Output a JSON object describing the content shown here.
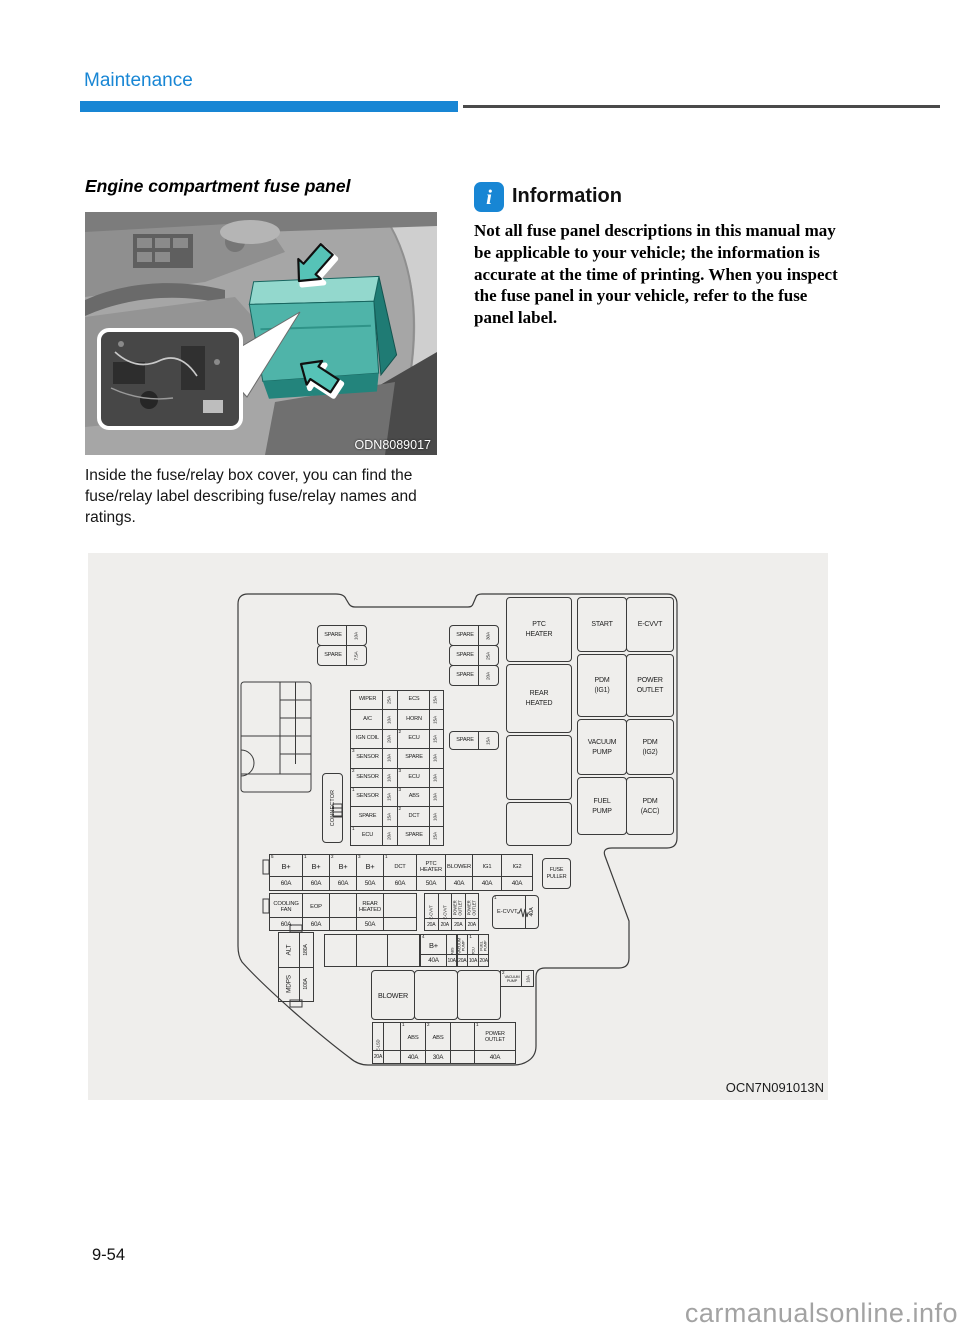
{
  "page": {
    "section": "Maintenance",
    "page_number": "9-54",
    "watermark": "carmanualsonline.info"
  },
  "left": {
    "heading": "Engine compartment fuse panel",
    "photo_code": "ODN8089017",
    "body": "Inside the fuse/relay box cover, you can find the fuse/relay label describing fuse/relay names and ratings."
  },
  "info": {
    "icon": "i",
    "title": "Information",
    "text": "Not all fuse panel descriptions in this manual may be applicable to your vehicle; the information is accurate at the time of printing. When you inspect the fuse panel in your vehicle, refer to the fuse panel label."
  },
  "figure": {
    "code": "OCN7N091013N"
  },
  "colors": {
    "accent_blue": "#1886d4",
    "panel_gray": "#efeeec",
    "fusebox_teal": "#4fb4a9"
  },
  "diagram": {
    "connector": "CONNECTOR",
    "spares_top_left": [
      [
        "SPARE",
        "10A"
      ],
      [
        "SPARE",
        "7.5A"
      ]
    ],
    "spares_top_right": [
      [
        "SPARE",
        "30A"
      ],
      [
        "SPARE",
        "25A"
      ],
      [
        "SPARE",
        "20A"
      ]
    ],
    "spare_mid": [
      "SPARE",
      "15A"
    ],
    "grid_rows": [
      [
        [
          "",
          "WIPER",
          "25A"
        ],
        [
          "",
          "ECS",
          "15A"
        ]
      ],
      [
        [
          "",
          "A/C",
          "10A"
        ],
        [
          "",
          "HORN",
          "15A"
        ]
      ],
      [
        [
          "",
          "IGN COIL",
          "20A"
        ],
        [
          "2",
          "ECU",
          "15A"
        ]
      ],
      [
        [
          "3",
          "SENSOR",
          "10A"
        ],
        [
          "",
          "SPARE",
          "10A"
        ]
      ],
      [
        [
          "2",
          "SENSOR",
          "10A"
        ],
        [
          "3",
          "ECU",
          "10A"
        ]
      ],
      [
        [
          "1",
          "SENSOR",
          "15A"
        ],
        [
          "3",
          "ABS",
          "10A"
        ]
      ],
      [
        [
          "",
          "SPARE",
          "15A"
        ],
        [
          "2",
          "DCT",
          "10A"
        ]
      ],
      [
        [
          "1",
          "ECU",
          "20A"
        ],
        [
          "",
          "SPARE",
          "15A"
        ]
      ]
    ],
    "relays": [
      [
        "PTC",
        "HEATER"
      ],
      [
        "REAR",
        "HEATED"
      ],
      [],
      [],
      [
        "START"
      ],
      [
        "E-CVVT"
      ],
      [
        "PDM",
        "(IG1)"
      ],
      [
        "POWER",
        "OUTLET"
      ],
      [
        "VACUUM",
        "PUMP"
      ],
      [
        "PDM",
        "(IG2)"
      ],
      [
        "FUEL",
        "PUMP"
      ],
      [
        "PDM",
        "(ACC)"
      ]
    ],
    "row_a": [
      [
        "5",
        "B+",
        "60A"
      ],
      [
        "1",
        "B+",
        "60A"
      ],
      [
        "2",
        "B+",
        "60A"
      ],
      [
        "3",
        "B+",
        "50A"
      ],
      [
        "1",
        "DCT",
        "60A"
      ],
      [
        "",
        "PTC HEATER",
        "50A"
      ],
      [
        "",
        "BLOWER",
        "40A"
      ],
      [
        "",
        "IG1",
        "40A"
      ],
      [
        "",
        "IG2",
        "40A"
      ]
    ],
    "fuse_puller": [
      "FUSE",
      "PULLER"
    ],
    "row_b": [
      [
        "",
        "COOLING FAN",
        "60A"
      ],
      [
        "",
        "EOP",
        "60A"
      ],
      [
        "",
        "",
        ""
      ],
      [
        "",
        "REAR HEATED",
        "50A"
      ],
      [
        "",
        "",
        ""
      ]
    ],
    "row_b_vertical": [
      [
        "",
        "E-CVVT",
        "20A"
      ],
      [
        "",
        "E-CVVT",
        "20A"
      ],
      [
        "",
        "POWER OUTLET",
        "20A"
      ],
      [
        "",
        "POWER OUTLET",
        "20A"
      ]
    ],
    "ecvvt_fuse": [
      "1",
      "E-CVVT",
      "40A"
    ],
    "alt_mdps": [
      [
        "ALT",
        "180A"
      ],
      [
        "MDPS",
        "100A"
      ]
    ],
    "row_c": [
      [
        "4",
        "B+",
        "40A"
      ],
      [
        "",
        "ABS",
        "10A"
      ],
      [
        "",
        "VACUUM PUMP",
        "20A"
      ],
      [
        "1",
        "TCU",
        "10A"
      ],
      [
        "",
        "FUEL PUMP",
        "20A"
      ]
    ],
    "vacuum_small": [
      "2",
      "VACUUM PUMP",
      "10A"
    ],
    "blower": "BLOWER",
    "bottom_row": [
      [
        "",
        "E-LSD",
        "20A"
      ],
      [
        "",
        "",
        ""
      ],
      [
        "1",
        "ABS",
        "40A"
      ],
      [
        "2",
        "ABS",
        "30A"
      ],
      [
        "",
        "",
        ""
      ],
      [
        "1",
        "POWER OUTLET",
        "40A"
      ]
    ]
  }
}
